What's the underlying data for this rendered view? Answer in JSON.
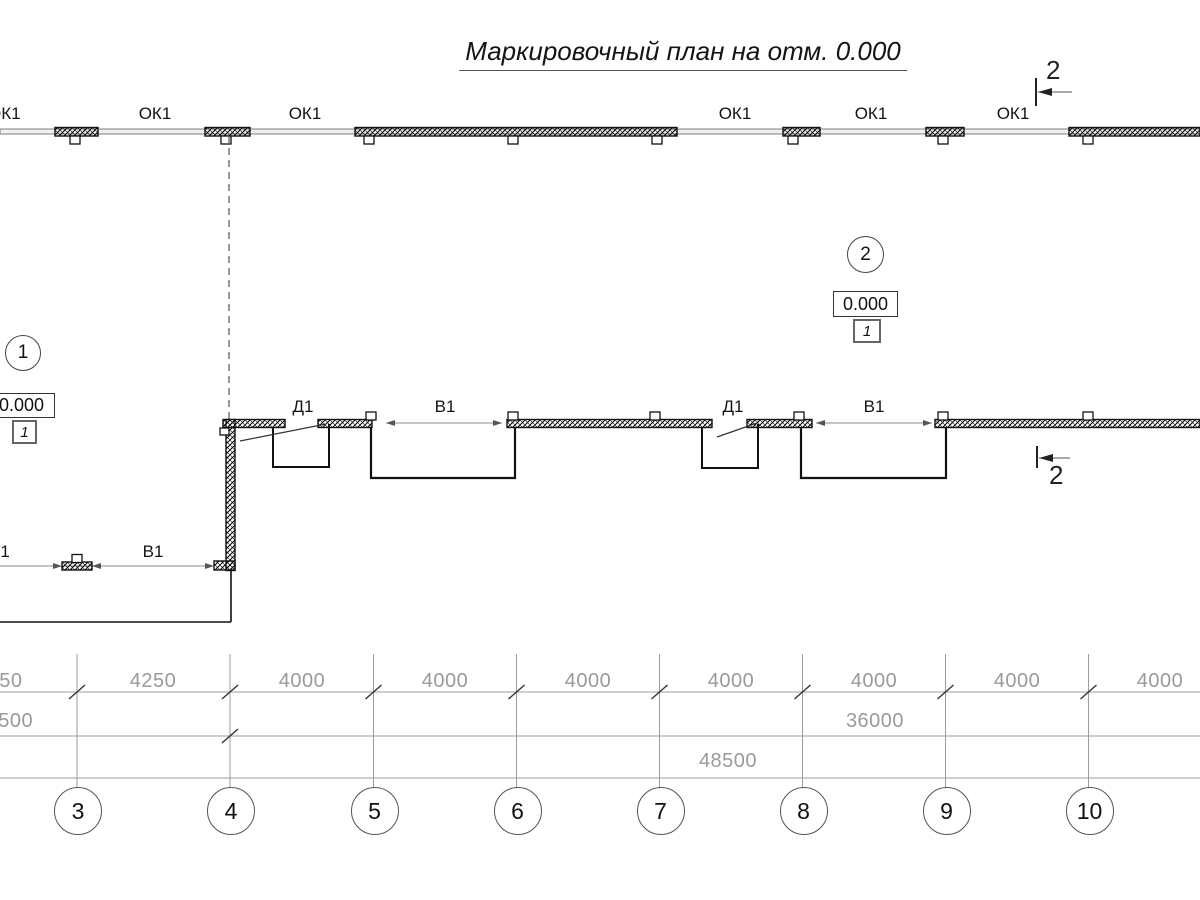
{
  "title": "Маркировочный план на отм. 0.000",
  "section_marks": {
    "top": "2",
    "bottom": "2"
  },
  "labels": {
    "windows": [
      "ОК1",
      "ОК1",
      "ОК1",
      "ОК1",
      "ОК1",
      "ОК1"
    ],
    "doors": [
      "Д1",
      "Д1"
    ],
    "gates": [
      "В1",
      "В1",
      "В1",
      "В1"
    ]
  },
  "room_markers": [
    {
      "number": "1",
      "elevation": "0.000",
      "zone": "1"
    },
    {
      "number": "2",
      "elevation": "0.000",
      "zone": "1"
    }
  ],
  "dimensions": {
    "row1": [
      "4250",
      "4250",
      "4000",
      "4000",
      "4000",
      "4000",
      "4000",
      "4000",
      "4000"
    ],
    "row2": [
      "12500",
      "36000"
    ],
    "row3": [
      "48500"
    ]
  },
  "axes": [
    "3",
    "4",
    "5",
    "6",
    "7",
    "8",
    "9",
    "10"
  ],
  "colors": {
    "line_black": "#111111",
    "line_gray": "#999999",
    "dim_text_gray": "#9a9a9a"
  }
}
